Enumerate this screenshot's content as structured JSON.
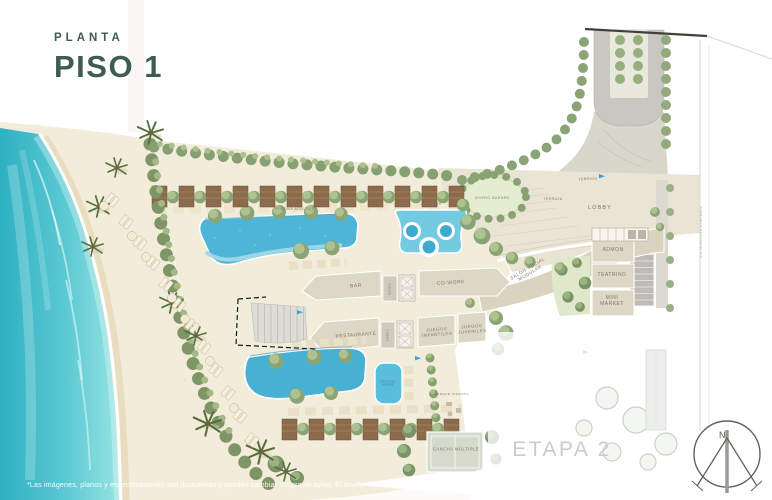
{
  "title": {
    "kicker": "PLANTA",
    "main": "PISO 1"
  },
  "colors": {
    "accent": "#3E5C52",
    "sea": "#4FC4CE",
    "pool": "#4EB5D6",
    "greenery": "#8CA475",
    "building": "#DDD8C6",
    "etapa_text": "#CBCBCB"
  },
  "plan": {
    "areas": {
      "piscina_adultos": "PISCINA ADULTOS",
      "jacuzzis": "JACUZZIS",
      "vivero_garden": "VIVERO GARDEN",
      "terraza": "TERRAZA",
      "lobby": "LOBBY",
      "admon": "ADMON",
      "teatrino": "TEATRINO",
      "mini_market": "MINI MARKET",
      "salon_social": "SALÓN SOCIAL MODULAR",
      "bar": "BAR",
      "cowork": "CO-WORK",
      "banos": "BAÑOS",
      "restaurante": "RESTAURANTE",
      "juegos_infantiles": "JUEGOS INFANTILES",
      "juegos_juveniles": "JUEGOS JUVENILES",
      "piscina_ninos": "PISCINA NIÑOS",
      "parque_infantil": "PARQUE INFANTIL",
      "cancha_multiple": "CANCHA MÚLTIPLE",
      "etapa_2": "ETAPA 2"
    },
    "annotations": {
      "via_existente": "VÍA VEHICULAR EXISTENTE"
    },
    "compass": {
      "north": "N"
    }
  },
  "footer": {
    "disclaimer": "*Las imágenes, planos y especificaciones son ilustrativas y pueden cambiar sin previo aviso. El diseño final podrá variar a discreción del desarrollador."
  }
}
